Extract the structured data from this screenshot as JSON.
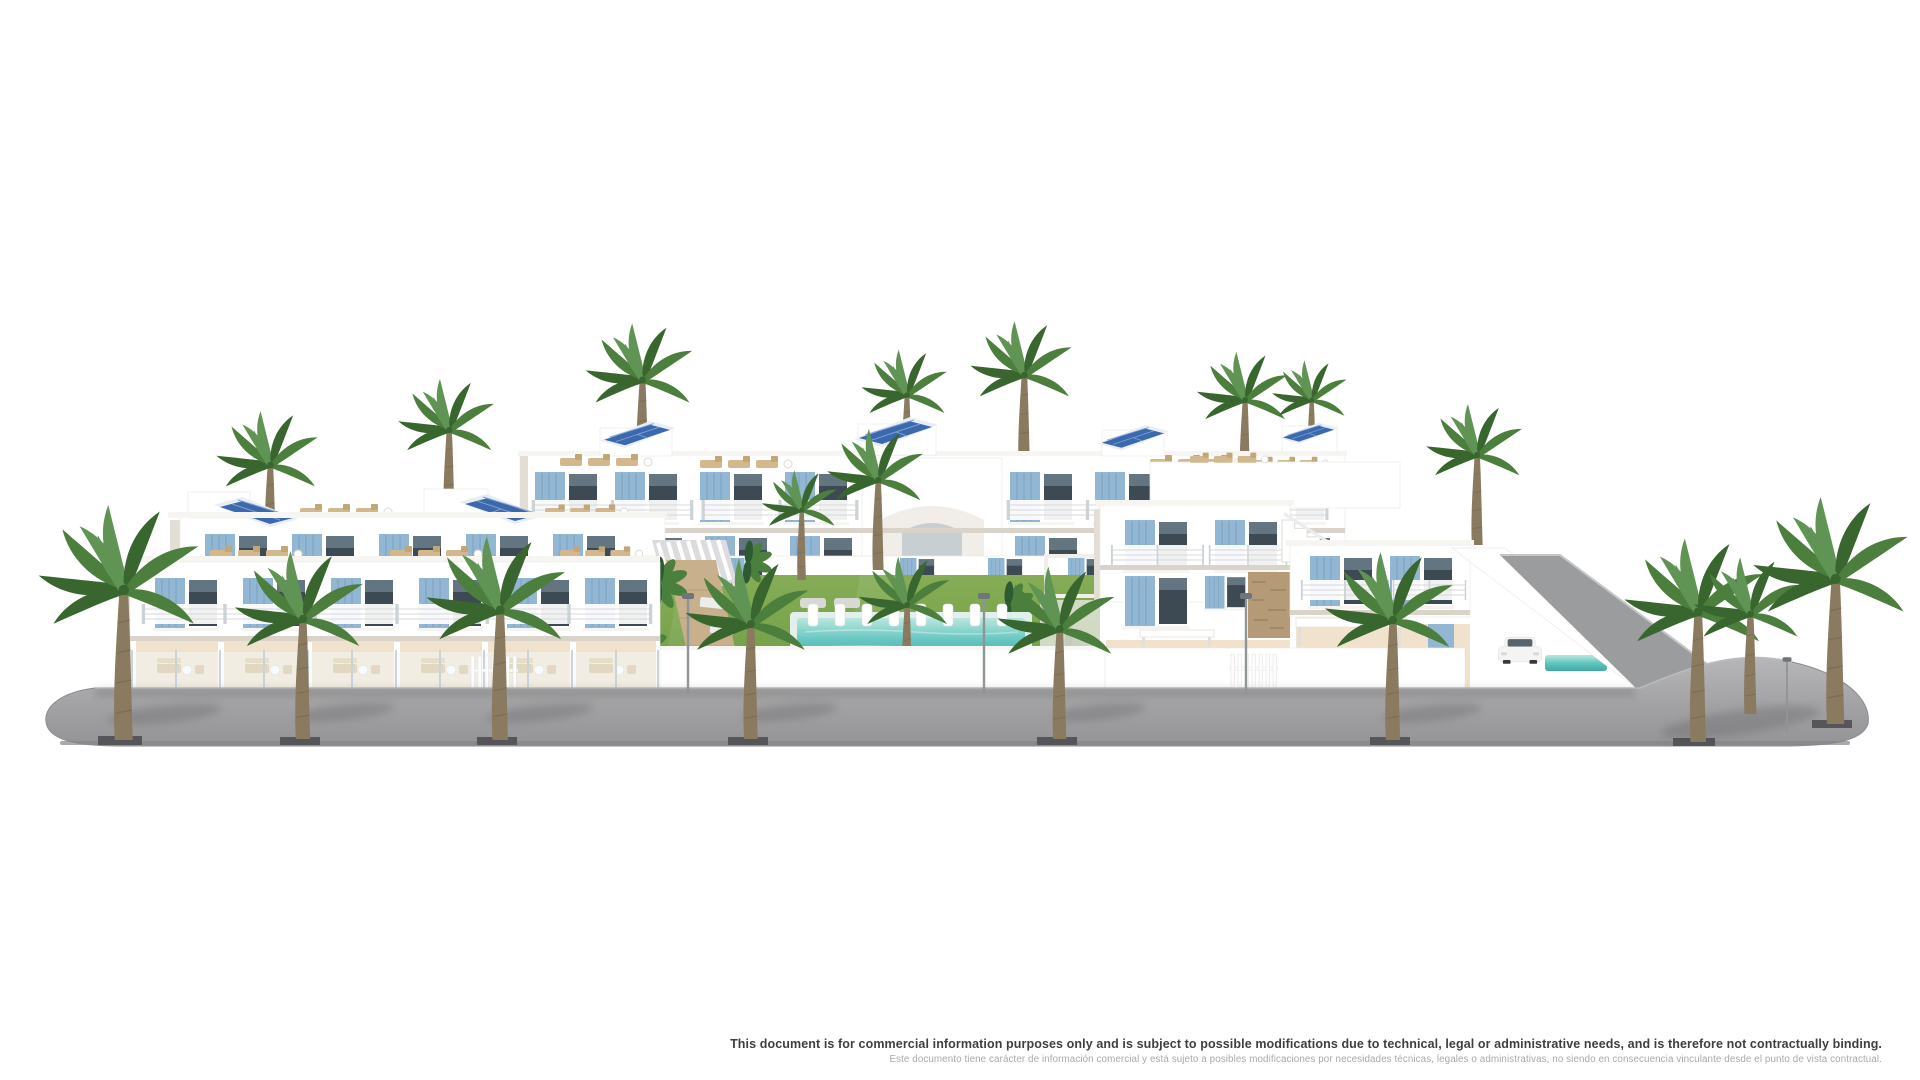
{
  "disclaimer": {
    "line1_en": "This document is for commercial information purposes only and is subject to possible modifications due to technical, legal or administrative needs, and is therefore not contractually binding.",
    "line2_es": "Este documento tiene carácter de información comercial y está sujeto a posibles modificaciones por necesidades técnicas, legales o administrativas, no siendo en consecuencia vinculante desde el punto de vista contractual."
  },
  "scene": {
    "description": "3D architectural rendering of a white Mediterranean residential complex: terraced apartment blocks and villas with light-blue shutters, rooftop terraces with sun loungers and solar panels, a central communal garden with lawn and turquoise swimming pool, tropical plants, and palm trees along a curved grey sidewalk on a white background.",
    "palette": {
      "white": "#ffffff",
      "shade": "#f1eee9",
      "shade2": "#e3ded5",
      "slab": "#d9d3c9",
      "terrace": "#f0e2cc",
      "tan": "#d2b88c",
      "wood": "#c9b08c",
      "shutter": "#93b6d3",
      "shutterD": "#7aa3c4",
      "glass": "#3d4a54",
      "glassL": "#8aa0ae",
      "solar": "#3a69ae",
      "solarL": "#7fa0d4",
      "frame": "#e9eef5",
      "lawn": "#79a24c",
      "lawnL": "#8db35c",
      "plant": "#2e5a31",
      "plantL": "#4a7f3d",
      "palm1": "#39652e",
      "palm2": "#4c7f3e",
      "palm3": "#609454",
      "trunk": "#8a7a60",
      "trunkD": "#6e6049",
      "poolEdge": "#e3efeb",
      "pool": "#57bfba",
      "poolD": "#3b9e99",
      "stone": "#b59a77",
      "red": "#b04040",
      "road": "#a4a4a6",
      "roadTop": "#b7b7b9",
      "curb": "#85858a",
      "pit": "#55555a",
      "lamp": "#8f9496",
      "textDark": "#3f3f3f",
      "textLight": "#a9a9a9"
    }
  }
}
